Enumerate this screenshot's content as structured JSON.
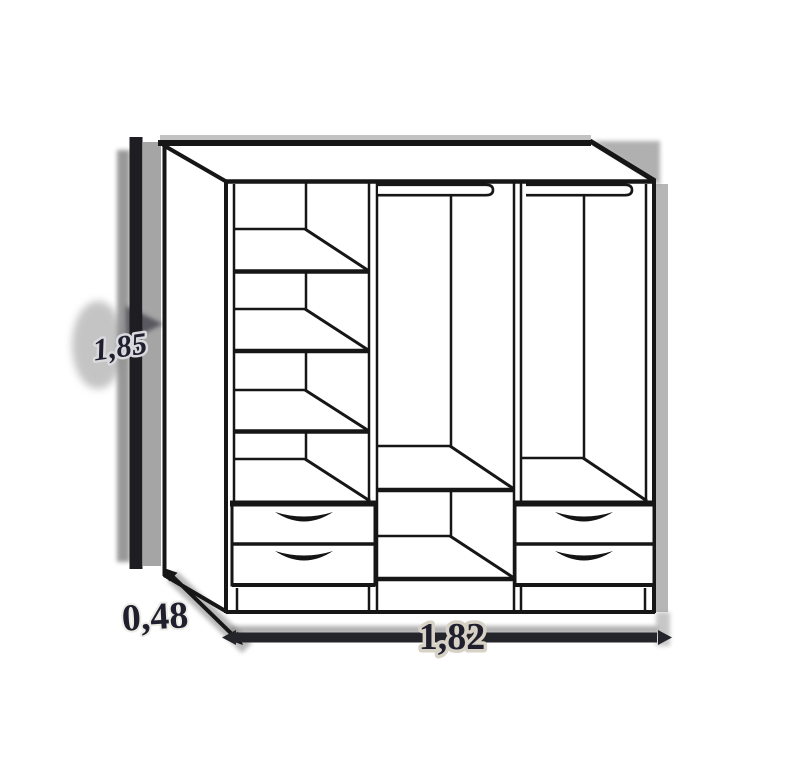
{
  "diagram": {
    "title": "Wardrobe dimension drawing",
    "dimensions": {
      "height": {
        "label": "1,85"
      },
      "depth": {
        "label": "0,48"
      },
      "width": {
        "label": "1,82"
      }
    },
    "colors": {
      "line": "#161616",
      "shadow": "#8f8f8f",
      "label": "#1f1f2e",
      "background": "#ffffff"
    }
  }
}
